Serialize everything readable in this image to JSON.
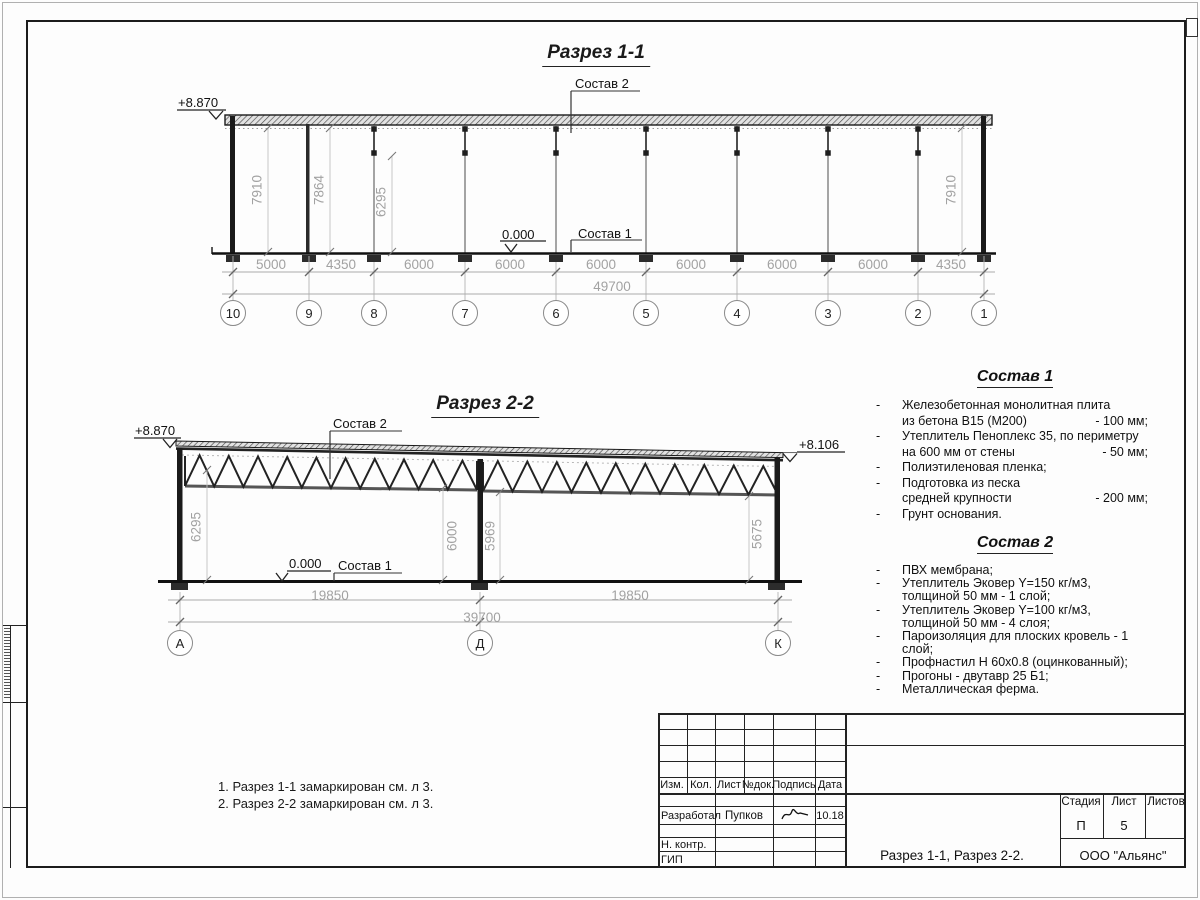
{
  "sheet": {
    "section1": {
      "title": "Разрез 1-1",
      "elev_top": "+8.870",
      "elev_zero": "0.000",
      "leader_top": "Состав 2",
      "leader_floor": "Состав 1",
      "dims": [
        "5000",
        "4350",
        "6000",
        "6000",
        "6000",
        "6000",
        "6000",
        "6000",
        "4350"
      ],
      "total": "49700",
      "vdims": [
        "7910",
        "7864",
        "6295",
        "7910"
      ],
      "axes": [
        "10",
        "9",
        "8",
        "7",
        "6",
        "5",
        "4",
        "3",
        "2",
        "1"
      ]
    },
    "section2": {
      "title": "Разрез 2-2",
      "elev_left": "+8.870",
      "elev_right": "+8.106",
      "elev_zero": "0.000",
      "leader_top": "Состав 2",
      "leader_floor": "Состав 1",
      "dims": [
        "19850",
        "19850"
      ],
      "total": "39700",
      "vdims": [
        "6295",
        "6000",
        "5969",
        "5675"
      ],
      "axes": [
        "А",
        "Д",
        "К"
      ]
    },
    "compose1": {
      "title": "Состав 1",
      "rows": [
        {
          "dash": "-",
          "text": "Железобетонная  монолитная плита",
          "value": ""
        },
        {
          "dash": "",
          "text": "из бетона В15 (М200)",
          "value": "- 100 мм;"
        },
        {
          "dash": "-",
          "text": "Утеплитель Пеноплекс 35, по периметру",
          "value": ""
        },
        {
          "dash": "",
          "text": "на 600 мм от стены",
          "value": "- 50 мм;"
        },
        {
          "dash": "-",
          "text": "Полиэтиленовая пленка;",
          "value": ""
        },
        {
          "dash": "-",
          "text": "Подготовка из песка",
          "value": ""
        },
        {
          "dash": "",
          "text": "средней крупности",
          "value": "- 200 мм;"
        },
        {
          "dash": "-",
          "text": "Грунт основания.",
          "value": ""
        }
      ]
    },
    "compose2": {
      "title": "Состав 2",
      "rows": [
        {
          "dash": "-",
          "text": "ПВХ мембрана;"
        },
        {
          "dash": "-",
          "text": "Утеплитель Эковер Y=150 кг/м3,"
        },
        {
          "dash": "",
          "text": "толщиной 50 мм - 1 слой;"
        },
        {
          "dash": "-",
          "text": "Утеплитель Эковер Y=100 кг/м3,"
        },
        {
          "dash": "",
          "text": "толщиной 50 мм - 4 слоя;"
        },
        {
          "dash": "-",
          "text": "Пароизоляция для плоских кровель - 1 слой;"
        },
        {
          "dash": "-",
          "text": "Профнастил Н 60х0.8 (оцинкованный);"
        },
        {
          "dash": "-",
          "text": "Прогоны - двутавр 25 Б1;"
        },
        {
          "dash": "-",
          "text": "Металлическая ферма."
        }
      ]
    },
    "notes": [
      "1. Разрез 1-1 замаркирован см. л 3.",
      "2. Разрез 2-2 замаркирован см. л 3."
    ],
    "titleblock": {
      "cols": [
        "Изм.",
        "Кол.",
        "Лист",
        "№док.",
        "Подпись",
        "Дата"
      ],
      "developed_label": "Разработал",
      "developed_name": "Пупков",
      "date": "10.18",
      "ncontr_label": "Н. контр.",
      "gip_label": "ГИП",
      "doc_title": "Разрез 1-1, Разрез 2-2.",
      "company": "ООО \"Альянс\"",
      "stage_label": "Стадия",
      "sheet_label": "Лист",
      "sheets_label": "Листов",
      "stage": "П",
      "sheet_no": "5"
    }
  }
}
